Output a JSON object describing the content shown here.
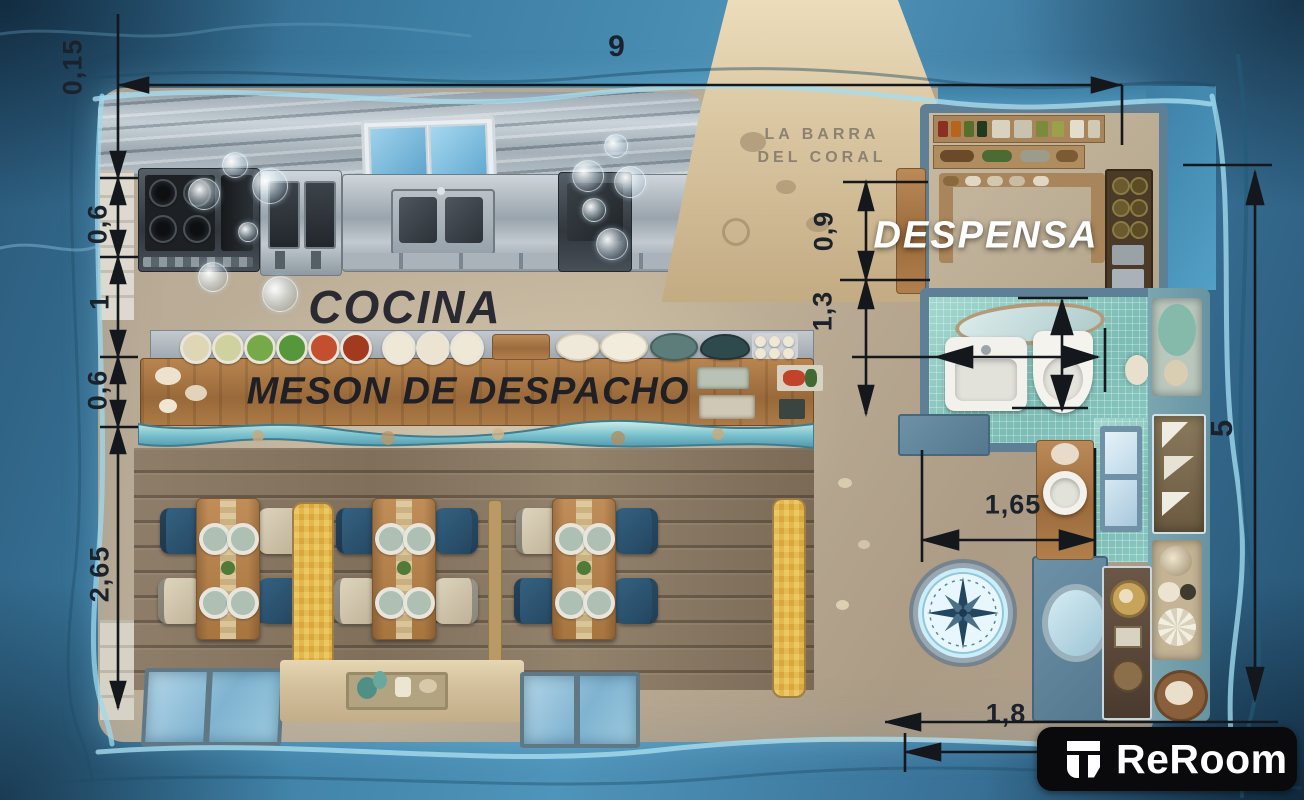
{
  "branding": {
    "restaurant_line1": "LA BARRA",
    "restaurant_line2": "DEL CORAL",
    "watermark": "ReRoom"
  },
  "rooms": {
    "kitchen": "COCINA",
    "counter": "MESON DE DESPACHO",
    "pantry": "DESPENSA"
  },
  "dimensions": {
    "top_width": "9",
    "left_chain": [
      "0,15",
      "0,6",
      "1",
      "0,6",
      "2,65"
    ],
    "entry_chain": [
      "0,9",
      "1,3"
    ],
    "vanity_width": "1,65",
    "walkway_width": "1,8",
    "right_height": "5"
  },
  "icons": {
    "compass_rose": "compass-rose",
    "reroom_logo": "reroom-r-glyph"
  },
  "colors": {
    "water_deep": "#1e4a66",
    "water_light": "#7db3d4",
    "rim_glow": "#a8dcee",
    "sand": "#cbb89a",
    "concrete": "#b3a492",
    "wood": "#a9744a",
    "steel": "#b7bec6",
    "tile_teal": "#8ccac2",
    "chair_navy": "#2e5a78",
    "chair_cream": "#d9d0bd",
    "dimension_text": "#1b222c",
    "label_dark": "#26262e",
    "label_white": "#ffffff",
    "logo_bg": "#0a0a0c"
  }
}
